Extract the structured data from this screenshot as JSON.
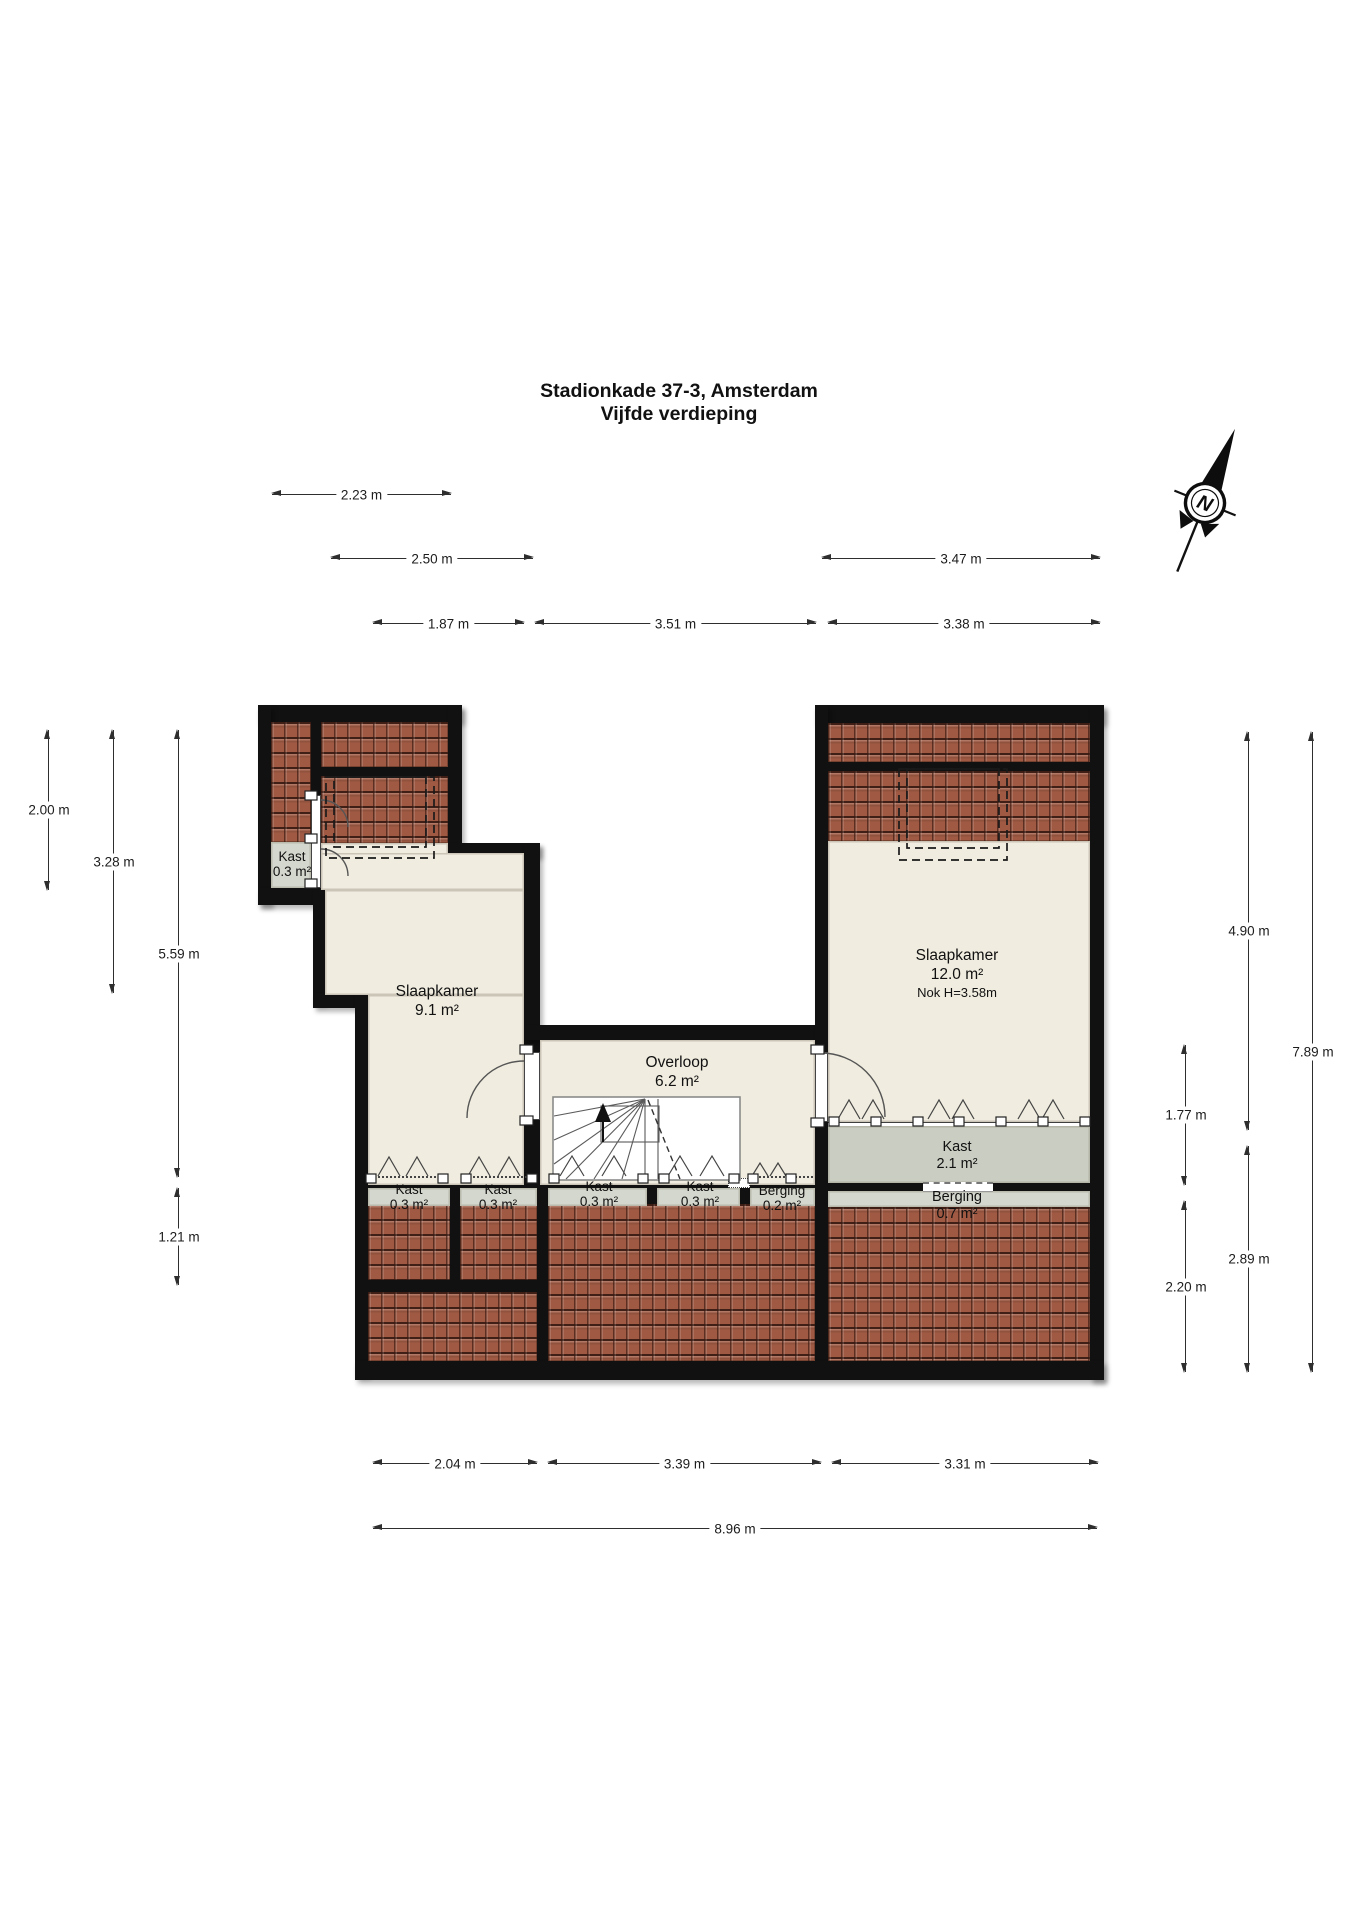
{
  "title": {
    "line1": "Stadionkade 37-3, Amsterdam",
    "line2": "Vijfde verdieping"
  },
  "compass": {
    "north_label": "N"
  },
  "rooms": {
    "kast_attic": {
      "name": "Kast",
      "area": "0.3 m²"
    },
    "slaapkamer_left": {
      "name": "Slaapkamer",
      "area": "9.1 m²"
    },
    "overloop": {
      "name": "Overloop",
      "area": "6.2 m²"
    },
    "slaapkamer_right": {
      "name": "Slaapkamer",
      "area": "12.0 m²",
      "note": "Nok H=3.58m"
    },
    "kast_a": {
      "name": "Kast",
      "area": "0.3 m²"
    },
    "kast_b": {
      "name": "Kast",
      "area": "0.3 m²"
    },
    "kast_c": {
      "name": "Kast",
      "area": "0.3 m²"
    },
    "kast_d": {
      "name": "Kast",
      "area": "0.3 m²"
    },
    "berging_small": {
      "name": "Berging",
      "area": "0.2 m²"
    },
    "kast_large": {
      "name": "Kast",
      "area": "2.1 m²"
    },
    "berging_large": {
      "name": "Berging",
      "area": "0.7 m²"
    }
  },
  "dimensions": {
    "top": [
      "2.23 m",
      "2.50 m",
      "3.47 m",
      "1.87 m",
      "3.51 m",
      "3.38 m"
    ],
    "left": [
      "2.00 m",
      "3.28 m",
      "5.59 m",
      "1.21 m"
    ],
    "right": [
      "1.77 m",
      "2.20 m",
      "4.90 m",
      "2.89 m",
      "7.89 m"
    ],
    "bottom": [
      "2.04 m",
      "3.39 m",
      "3.31 m",
      "8.96 m"
    ]
  },
  "colors": {
    "wall": "#111111",
    "floor": "#f0ecdf",
    "closet_floor": "#d4d7cd",
    "roof_tile": "#a05a44"
  }
}
